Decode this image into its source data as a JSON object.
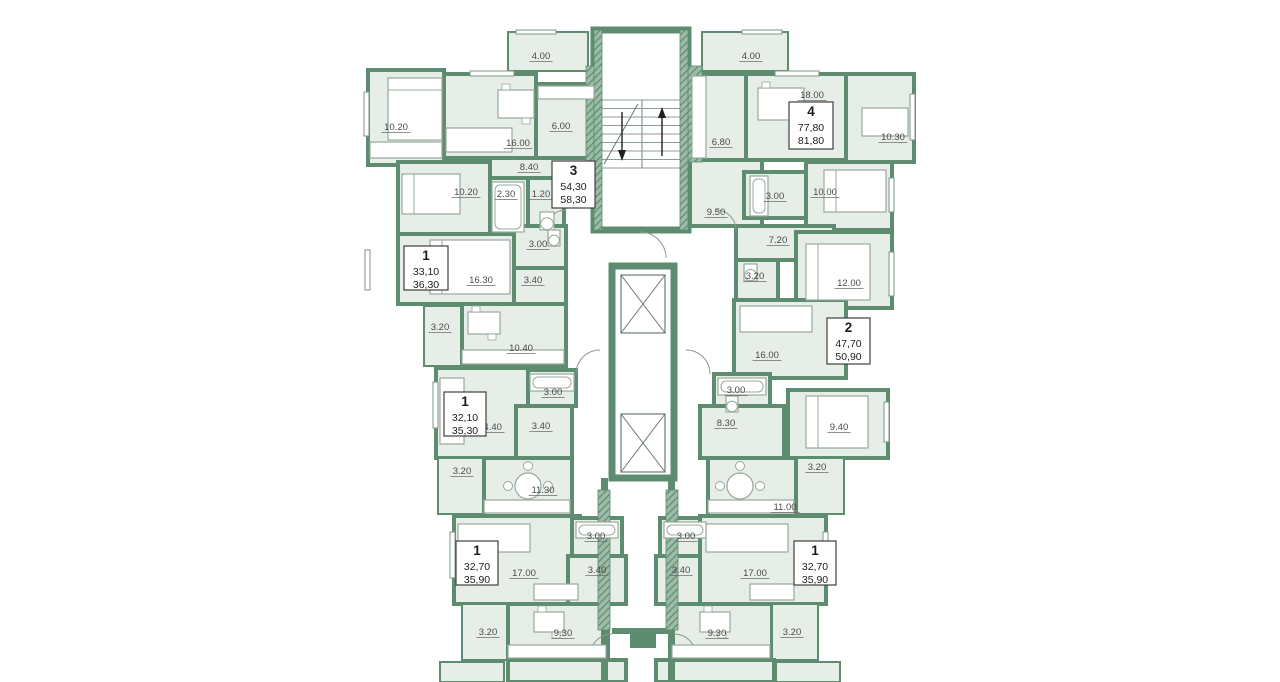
{
  "page": {
    "title": "Residential floor plan",
    "width": 1280,
    "height": 682,
    "background": "#ffffff"
  },
  "colors": {
    "wall": "#5d8c70",
    "wall_dark": "#4e7d62",
    "hatch_light": "#9dbba7",
    "floor": "#e7eee8",
    "white": "#ffffff",
    "furniture_outline": "#97a89b",
    "label_text": "#4a4a4a",
    "box_border": "#3f3f3f",
    "box_text": "#1d1d1d"
  },
  "plan": {
    "apartments": [
      {
        "n": "apartment-3-box",
        "num": "3",
        "area_living": "54,30",
        "area_total": "58,30",
        "x": 552,
        "y": 161,
        "w": 43,
        "h": 47
      },
      {
        "n": "apartment-4-box",
        "num": "4",
        "area_living": "77,80",
        "area_total": "81,80",
        "x": 789,
        "y": 102,
        "w": 44,
        "h": 47
      },
      {
        "n": "apartment-1a-box",
        "num": "1",
        "area_living": "33,10",
        "area_total": "36,30",
        "x": 404,
        "y": 246,
        "w": 44,
        "h": 44
      },
      {
        "n": "apartment-1b-box",
        "num": "1",
        "area_living": "32,10",
        "area_total": "35,30",
        "x": 444,
        "y": 392,
        "w": 42,
        "h": 44
      },
      {
        "n": "apartment-2-box",
        "num": "2",
        "area_living": "47,70",
        "area_total": "50,90",
        "x": 827,
        "y": 318,
        "w": 43,
        "h": 46
      },
      {
        "n": "apartment-1c-box",
        "num": "1",
        "area_living": "32,70",
        "area_total": "35,90",
        "x": 456,
        "y": 541,
        "w": 42,
        "h": 44
      },
      {
        "n": "apartment-1d-box",
        "num": "1",
        "area_living": "32,70",
        "area_total": "35,90",
        "x": 794,
        "y": 541,
        "w": 42,
        "h": 44
      }
    ],
    "rooms": [
      {
        "n": "room-bedroom",
        "l": "10.20",
        "x": 368,
        "y": 70,
        "w": 76,
        "h": 95,
        "lx": 396,
        "ly": 130
      },
      {
        "n": "room-living",
        "l": "16.00",
        "x": 444,
        "y": 74,
        "w": 92,
        "h": 84,
        "lx": 518,
        "ly": 146
      },
      {
        "n": "room-kitchen",
        "l": "6.00",
        "x": 536,
        "y": 84,
        "w": 60,
        "h": 74,
        "lx": 561,
        "ly": 129
      },
      {
        "n": "room-hall",
        "l": "8.40",
        "x": 468,
        "y": 158,
        "w": 128,
        "h": 36,
        "lx": 529,
        "ly": 170
      },
      {
        "n": "room-bedroom",
        "l": "10.20",
        "x": 398,
        "y": 162,
        "w": 92,
        "h": 72,
        "lx": 466,
        "ly": 195
      },
      {
        "n": "room-bath",
        "l": "2.30",
        "x": 490,
        "y": 178,
        "w": 38,
        "h": 56,
        "lx": 506,
        "ly": 197
      },
      {
        "n": "room-wc",
        "l": "1.20",
        "x": 528,
        "y": 178,
        "w": 36,
        "h": 56,
        "lx": 541,
        "ly": 197
      },
      {
        "n": "room-balcony",
        "l": "4.00",
        "x": 508,
        "y": 32,
        "w": 80,
        "h": 39,
        "lx": 541,
        "ly": 59,
        "s": 2
      },
      {
        "n": "room-living",
        "l": "16.30",
        "x": 398,
        "y": 234,
        "w": 116,
        "h": 70,
        "lx": 481,
        "ly": 283
      },
      {
        "n": "room-bath",
        "l": "3.00",
        "x": 514,
        "y": 226,
        "w": 52,
        "h": 42,
        "lx": 538,
        "ly": 247
      },
      {
        "n": "room-hall",
        "l": "3.40",
        "x": 514,
        "y": 268,
        "w": 52,
        "h": 38,
        "lx": 533,
        "ly": 283
      },
      {
        "n": "room-balcony",
        "l": "3.20",
        "x": 424,
        "y": 306,
        "w": 38,
        "h": 60,
        "lx": 440,
        "ly": 330,
        "s": 2
      },
      {
        "n": "room-kitchen",
        "l": "10.40",
        "x": 462,
        "y": 304,
        "w": 104,
        "h": 62,
        "lx": 521,
        "ly": 351
      },
      {
        "n": "room-living",
        "l": "14.40",
        "x": 436,
        "y": 368,
        "w": 96,
        "h": 90,
        "lx": 490,
        "ly": 430
      },
      {
        "n": "room-bath",
        "l": "3.00",
        "x": 528,
        "y": 370,
        "w": 48,
        "h": 36,
        "lx": 553,
        "ly": 395
      },
      {
        "n": "room-hall",
        "l": "3.40",
        "x": 516,
        "y": 406,
        "w": 56,
        "h": 52,
        "lx": 541,
        "ly": 429
      },
      {
        "n": "room-balcony",
        "l": "3.20",
        "x": 438,
        "y": 458,
        "w": 46,
        "h": 56,
        "lx": 462,
        "ly": 474,
        "s": 2
      },
      {
        "n": "room-kitchen",
        "l": "11.30",
        "x": 484,
        "y": 458,
        "w": 88,
        "h": 58,
        "lx": 543,
        "ly": 493
      },
      {
        "n": "room-living",
        "l": "17.00",
        "x": 454,
        "y": 516,
        "w": 126,
        "h": 88,
        "lx": 524,
        "ly": 576
      },
      {
        "n": "room-bath",
        "l": "3.00",
        "x": 572,
        "y": 518,
        "w": 50,
        "h": 38,
        "lx": 596,
        "ly": 539
      },
      {
        "n": "room-hall",
        "l": "3.40",
        "x": 568,
        "y": 556,
        "w": 58,
        "h": 48,
        "lx": 597,
        "ly": 573
      },
      {
        "n": "room-balcony",
        "l": "3.20",
        "x": 462,
        "y": 604,
        "w": 46,
        "h": 56,
        "lx": 488,
        "ly": 635,
        "s": 2
      },
      {
        "n": "room-kitchen",
        "l": "9.30",
        "x": 508,
        "y": 604,
        "w": 100,
        "h": 56,
        "lx": 563,
        "ly": 636
      },
      {
        "n": "room-balcony",
        "l": "4.00",
        "x": 702,
        "y": 32,
        "w": 86,
        "h": 39,
        "lx": 751,
        "ly": 59,
        "s": 2
      },
      {
        "n": "room-kitchen",
        "l": "6.80",
        "x": 690,
        "y": 74,
        "w": 56,
        "h": 86,
        "lx": 721,
        "ly": 145
      },
      {
        "n": "room-living",
        "l": "18.00",
        "x": 746,
        "y": 74,
        "w": 110,
        "h": 86,
        "lx": 812,
        "ly": 98
      },
      {
        "n": "room-study",
        "l": "10.30",
        "x": 846,
        "y": 74,
        "w": 68,
        "h": 88,
        "lx": 893,
        "ly": 140
      },
      {
        "n": "room-hall",
        "l": "9.50",
        "x": 690,
        "y": 160,
        "w": 72,
        "h": 66,
        "lx": 716,
        "ly": 215
      },
      {
        "n": "room-bath",
        "l": "3.00",
        "x": 744,
        "y": 172,
        "w": 62,
        "h": 46,
        "lx": 775,
        "ly": 199
      },
      {
        "n": "room-bedroom",
        "l": "10.00",
        "x": 806,
        "y": 162,
        "w": 86,
        "h": 68,
        "lx": 825,
        "ly": 195
      },
      {
        "n": "room-hall",
        "l": "7.20",
        "x": 736,
        "y": 226,
        "w": 98,
        "h": 34,
        "lx": 778,
        "ly": 243
      },
      {
        "n": "room-bath",
        "l": "3.20",
        "x": 736,
        "y": 260,
        "w": 42,
        "h": 50,
        "lx": 755,
        "ly": 279
      },
      {
        "n": "room-bedroom",
        "l": "12.00",
        "x": 796,
        "y": 232,
        "w": 96,
        "h": 76,
        "lx": 849,
        "ly": 286
      },
      {
        "n": "room-living",
        "l": "16.00",
        "x": 734,
        "y": 300,
        "w": 112,
        "h": 78,
        "lx": 767,
        "ly": 358
      },
      {
        "n": "room-bath",
        "l": "3.00",
        "x": 714,
        "y": 374,
        "w": 56,
        "h": 40,
        "lx": 736,
        "ly": 393
      },
      {
        "n": "room-hall",
        "l": "8.30",
        "x": 700,
        "y": 406,
        "w": 84,
        "h": 52,
        "lx": 726,
        "ly": 426
      },
      {
        "n": "room-bedroom",
        "l": "9.40",
        "x": 788,
        "y": 390,
        "w": 100,
        "h": 68,
        "lx": 839,
        "ly": 430
      },
      {
        "n": "room-balcony",
        "l": "3.20",
        "x": 796,
        "y": 458,
        "w": 48,
        "h": 56,
        "lx": 817,
        "ly": 470,
        "s": 2
      },
      {
        "n": "room-kitchen",
        "l": "11.00",
        "x": 708,
        "y": 458,
        "w": 88,
        "h": 58,
        "lx": 785,
        "ly": 510
      },
      {
        "n": "room-bath",
        "l": "3.00",
        "x": 660,
        "y": 518,
        "w": 50,
        "h": 38,
        "lx": 686,
        "ly": 539
      },
      {
        "n": "room-hall",
        "l": "3.40",
        "x": 656,
        "y": 556,
        "w": 58,
        "h": 48,
        "lx": 681,
        "ly": 573
      },
      {
        "n": "room-living",
        "l": "17.00",
        "x": 700,
        "y": 516,
        "w": 126,
        "h": 88,
        "lx": 755,
        "ly": 576
      },
      {
        "n": "room-kitchen",
        "l": "9.30",
        "x": 672,
        "y": 604,
        "w": 100,
        "h": 56,
        "lx": 717,
        "ly": 636
      },
      {
        "n": "room-balcony",
        "l": "3.20",
        "x": 772,
        "y": 604,
        "w": 46,
        "h": 56,
        "lx": 792,
        "ly": 635,
        "s": 2
      },
      {
        "n": "room-partial",
        "l": "",
        "x": 508,
        "y": 660,
        "w": 118,
        "h": 22
      },
      {
        "n": "room-partial",
        "l": "",
        "x": 656,
        "y": 660,
        "w": 118,
        "h": 22
      },
      {
        "n": "room-partial",
        "l": "",
        "x": 440,
        "y": 662,
        "w": 64,
        "h": 20,
        "s": 2
      },
      {
        "n": "room-partial",
        "l": "",
        "x": 776,
        "y": 662,
        "w": 64,
        "h": 20,
        "s": 2
      }
    ],
    "stairs": {
      "n": "staircase",
      "shaft": {
        "x": 594,
        "y": 30,
        "w": 94,
        "h": 200
      },
      "flight": {
        "x": 602,
        "y": 100,
        "w": 80,
        "h": 68
      },
      "treads": 8
    },
    "elevator_block": {
      "n": "elevator-shaft",
      "x": 612,
      "y": 266,
      "w": 62,
      "h": 212
    },
    "elevators": [
      {
        "n": "elevator-cab",
        "x": 621,
        "y": 275,
        "w": 44,
        "h": 58
      },
      {
        "n": "elevator-cab",
        "x": 621,
        "y": 414,
        "w": 44,
        "h": 58
      }
    ],
    "walls": [
      {
        "x": 601,
        "y": 478,
        "w": 7,
        "h": 204
      },
      {
        "x": 668,
        "y": 478,
        "w": 7,
        "h": 204
      },
      {
        "x": 612,
        "y": 628,
        "w": 62,
        "h": 6
      },
      {
        "x": 630,
        "y": 634,
        "w": 26,
        "h": 14
      },
      {
        "x": 574,
        "y": 650,
        "w": 34,
        "h": 7
      },
      {
        "x": 668,
        "y": 650,
        "w": 34,
        "h": 7
      }
    ],
    "hatch_walls": [
      {
        "x": 586,
        "y": 66,
        "w": 14,
        "h": 96
      },
      {
        "x": 688,
        "y": 66,
        "w": 14,
        "h": 96
      },
      {
        "x": 598,
        "y": 490,
        "w": 12,
        "h": 140
      },
      {
        "x": 666,
        "y": 490,
        "w": 12,
        "h": 140
      },
      {
        "x": 594,
        "y": 30,
        "w": 8,
        "h": 200
      },
      {
        "x": 680,
        "y": 30,
        "w": 8,
        "h": 200
      }
    ],
    "windows": [
      {
        "x": 364,
        "y": 92,
        "w": 5,
        "h": 44
      },
      {
        "x": 365,
        "y": 250,
        "w": 5,
        "h": 40
      },
      {
        "x": 433,
        "y": 382,
        "w": 5,
        "h": 46
      },
      {
        "x": 450,
        "y": 532,
        "w": 5,
        "h": 46
      },
      {
        "x": 470,
        "y": 71,
        "w": 44,
        "h": 5
      },
      {
        "x": 775,
        "y": 71,
        "w": 44,
        "h": 5
      },
      {
        "x": 910,
        "y": 94,
        "w": 5,
        "h": 46
      },
      {
        "x": 889,
        "y": 178,
        "w": 5,
        "h": 34
      },
      {
        "x": 889,
        "y": 252,
        "w": 5,
        "h": 44
      },
      {
        "x": 884,
        "y": 402,
        "w": 5,
        "h": 40
      },
      {
        "x": 823,
        "y": 532,
        "w": 5,
        "h": 46
      },
      {
        "x": 516,
        "y": 30,
        "w": 40,
        "h": 4
      },
      {
        "x": 742,
        "y": 30,
        "w": 40,
        "h": 4
      }
    ],
    "furniture": [
      {
        "t": "bed",
        "n": "double-bed",
        "x": 388,
        "y": 78,
        "w": 54,
        "h": 62
      },
      {
        "t": "bed",
        "n": "bed",
        "x": 402,
        "y": 174,
        "w": 58,
        "h": 40
      },
      {
        "t": "bed",
        "n": "double-bed",
        "x": 430,
        "y": 240,
        "w": 80,
        "h": 54
      },
      {
        "t": "bed",
        "n": "bed",
        "x": 824,
        "y": 170,
        "w": 62,
        "h": 42
      },
      {
        "t": "bed",
        "n": "double-bed",
        "x": 806,
        "y": 244,
        "w": 64,
        "h": 56
      },
      {
        "t": "bed",
        "n": "double-bed",
        "x": 806,
        "y": 396,
        "w": 62,
        "h": 52
      },
      {
        "t": "rect",
        "n": "sofa",
        "x": 446,
        "y": 128,
        "w": 66,
        "h": 24
      },
      {
        "t": "rect",
        "n": "sofa",
        "x": 740,
        "y": 306,
        "w": 72,
        "h": 26
      },
      {
        "t": "rect",
        "n": "sofa",
        "x": 706,
        "y": 524,
        "w": 82,
        "h": 28
      },
      {
        "t": "rect",
        "n": "sofa",
        "x": 458,
        "y": 524,
        "w": 72,
        "h": 28
      },
      {
        "t": "rect",
        "n": "sofa",
        "x": 440,
        "y": 378,
        "w": 24,
        "h": 66
      },
      {
        "t": "table",
        "n": "dining-table",
        "x": 498,
        "y": 90,
        "w": 36,
        "h": 28
      },
      {
        "t": "table",
        "n": "dining-table",
        "x": 758,
        "y": 88,
        "w": 46,
        "h": 32
      },
      {
        "t": "table",
        "n": "kitchen-table",
        "x": 468,
        "y": 312,
        "w": 32,
        "h": 22
      },
      {
        "t": "table",
        "n": "kitchen-table",
        "x": 534,
        "y": 612,
        "w": 30,
        "h": 20
      },
      {
        "t": "table",
        "n": "kitchen-table",
        "x": 700,
        "y": 612,
        "w": 30,
        "h": 20
      },
      {
        "t": "ctable",
        "n": "round-table",
        "cx": 528,
        "cy": 486,
        "r": 13
      },
      {
        "t": "ctable",
        "n": "round-table",
        "cx": 740,
        "cy": 486,
        "r": 13
      },
      {
        "t": "rect",
        "n": "kitchen-counter",
        "x": 538,
        "y": 86,
        "w": 56,
        "h": 13
      },
      {
        "t": "rect",
        "n": "kitchen-counter",
        "x": 462,
        "y": 350,
        "w": 102,
        "h": 14
      },
      {
        "t": "rect",
        "n": "kitchen-counter",
        "x": 484,
        "y": 500,
        "w": 86,
        "h": 13
      },
      {
        "t": "rect",
        "n": "kitchen-counter",
        "x": 508,
        "y": 645,
        "w": 98,
        "h": 13
      },
      {
        "t": "rect",
        "n": "kitchen-counter",
        "x": 672,
        "y": 645,
        "w": 98,
        "h": 13
      },
      {
        "t": "rect",
        "n": "kitchen-counter",
        "x": 692,
        "y": 76,
        "w": 14,
        "h": 82
      },
      {
        "t": "rect",
        "n": "kitchen-counter",
        "x": 708,
        "y": 500,
        "w": 86,
        "h": 13
      },
      {
        "t": "rect",
        "n": "wardrobe",
        "x": 370,
        "y": 142,
        "w": 72,
        "h": 16
      },
      {
        "t": "rect",
        "n": "wardrobe",
        "x": 534,
        "y": 584,
        "w": 44,
        "h": 16
      },
      {
        "t": "rect",
        "n": "wardrobe",
        "x": 750,
        "y": 584,
        "w": 44,
        "h": 16
      },
      {
        "t": "rect",
        "n": "desk",
        "x": 862,
        "y": 108,
        "w": 46,
        "h": 28
      },
      {
        "t": "tub",
        "n": "bathtub",
        "x": 492,
        "y": 182,
        "w": 32,
        "h": 50
      },
      {
        "t": "tub",
        "n": "bathtub",
        "x": 530,
        "y": 374,
        "w": 44,
        "h": 17
      },
      {
        "t": "tub",
        "n": "bathtub",
        "x": 750,
        "y": 176,
        "w": 18,
        "h": 40
      },
      {
        "t": "tub",
        "n": "bathtub",
        "x": 718,
        "y": 378,
        "w": 48,
        "h": 17
      },
      {
        "t": "tub",
        "n": "bathtub",
        "x": 576,
        "y": 522,
        "w": 42,
        "h": 16
      },
      {
        "t": "tub",
        "n": "bathtub",
        "x": 664,
        "y": 522,
        "w": 42,
        "h": 16
      },
      {
        "t": "wc",
        "n": "toilet",
        "x": 540,
        "y": 212,
        "w": 14,
        "h": 18
      },
      {
        "t": "wc",
        "n": "toilet",
        "x": 548,
        "y": 230,
        "w": 12,
        "h": 16
      },
      {
        "t": "wc",
        "n": "toilet",
        "x": 744,
        "y": 264,
        "w": 13,
        "h": 17
      },
      {
        "t": "wc",
        "n": "toilet",
        "x": 726,
        "y": 396,
        "w": 12,
        "h": 16
      }
    ],
    "arcs": [
      "M640,232 A26,26 0 0 1 666,258",
      "M600,350 A24,24 0 0 0 576,374",
      "M686,350 A24,24 0 0 1 710,374",
      "M566,210 A20,20 0 0 0 546,230",
      "M716,210 A20,20 0 0 1 736,230",
      "M612,634 A22,22 0 0 0 590,656",
      "M674,634 A22,22 0 0 1 696,656"
    ]
  }
}
